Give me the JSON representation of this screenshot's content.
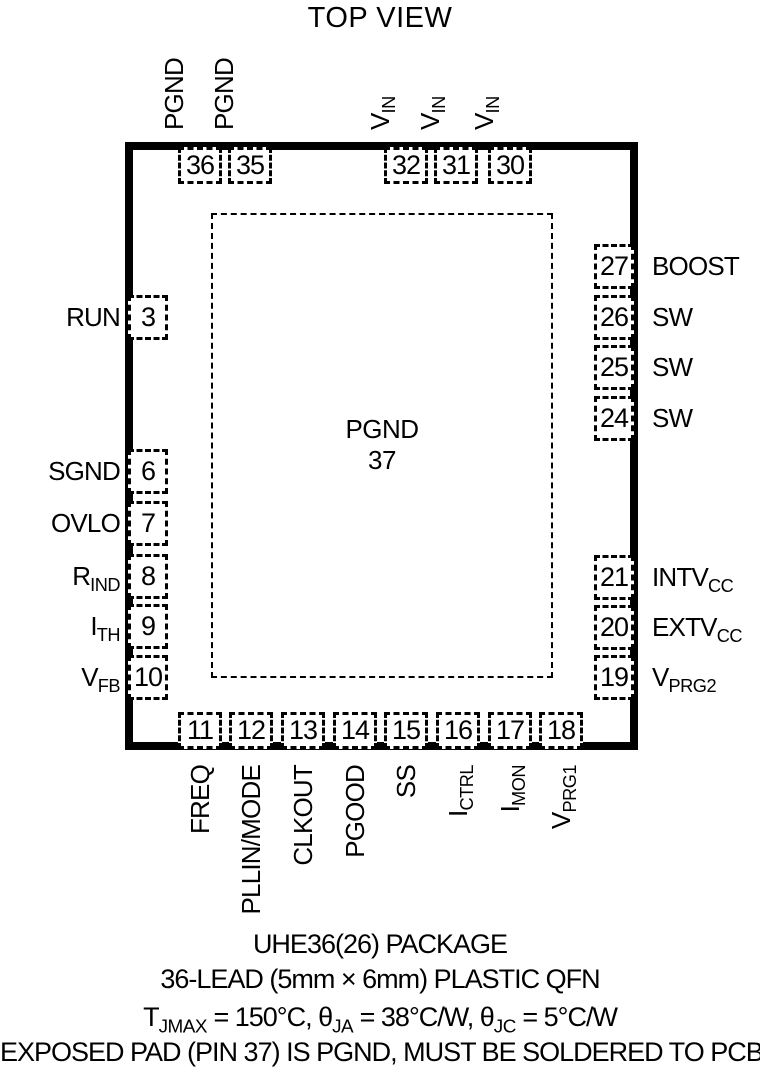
{
  "title": "TOP VIEW",
  "chip": {
    "center_pad_label": "PGND",
    "center_pad_pin": "37",
    "pins_top": [
      {
        "num": "36",
        "label": "PGND"
      },
      {
        "num": "35",
        "label": "PGND"
      },
      {
        "num": "32",
        "label": "V_{IN}"
      },
      {
        "num": "31",
        "label": "V_{IN}"
      },
      {
        "num": "30",
        "label": "V_{IN}"
      }
    ],
    "pins_left": [
      {
        "num": "3",
        "label": "RUN"
      },
      {
        "num": "6",
        "label": "SGND"
      },
      {
        "num": "7",
        "label": "OVLO"
      },
      {
        "num": "8",
        "label": "R_{IND}"
      },
      {
        "num": "9",
        "label": "I_{TH}"
      },
      {
        "num": "10",
        "label": "V_{FB}"
      }
    ],
    "pins_right": [
      {
        "num": "27",
        "label": "BOOST"
      },
      {
        "num": "26",
        "label": "SW"
      },
      {
        "num": "25",
        "label": "SW"
      },
      {
        "num": "24",
        "label": "SW"
      },
      {
        "num": "21",
        "label": "INTV_{CC}"
      },
      {
        "num": "20",
        "label": "EXTV_{CC}"
      },
      {
        "num": "19",
        "label": "V_{PRG2}"
      }
    ],
    "pins_bottom": [
      {
        "num": "11",
        "label": "FREQ"
      },
      {
        "num": "12",
        "label": "PLLIN/MODE"
      },
      {
        "num": "13",
        "label": "CLKOUT"
      },
      {
        "num": "14",
        "label": "PGOOD"
      },
      {
        "num": "15",
        "label": "SS"
      },
      {
        "num": "16",
        "label": "I_{CTRL}"
      },
      {
        "num": "17",
        "label": "I_{MON}"
      },
      {
        "num": "18",
        "label": "V_{PRG1}"
      }
    ]
  },
  "footer": {
    "line1": "UHE36(26) PACKAGE",
    "line2": "36-LEAD (5mm × 6mm) PLASTIC QFN",
    "line3": "T_{JMAX} = 150°C, θ_{JA} = 38°C/W, θ_{JC} = 5°C/W",
    "line4": "EXPOSED PAD (PIN 37) IS PGND, MUST BE SOLDERED TO PCB"
  },
  "colors": {
    "ink": "#000000",
    "background": "#ffffff"
  }
}
